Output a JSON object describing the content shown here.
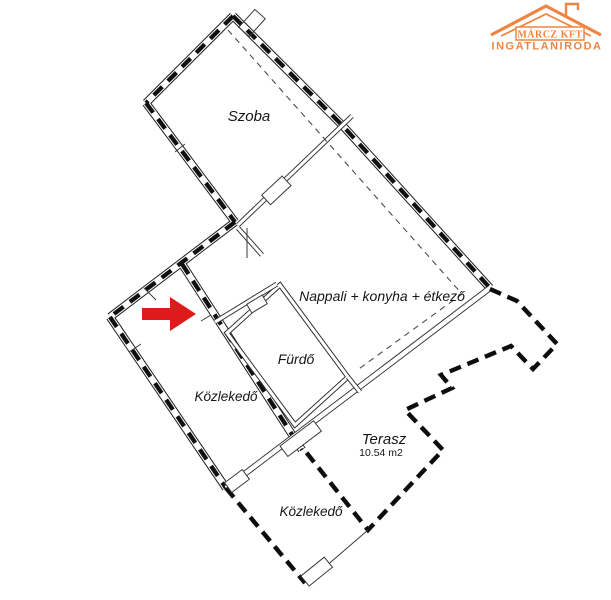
{
  "logo": {
    "company": "MÁRCZ KFT",
    "subtitle": "INGATLANIRODA",
    "accent_color": "#ED8540"
  },
  "rooms": {
    "szoba": {
      "label": "Szoba"
    },
    "nappali": {
      "label": "Nappali + konyha + étkező"
    },
    "furdo": {
      "label": "Fürdő"
    },
    "kozlekedo_left": {
      "label": "Közlekedő"
    },
    "terasz": {
      "label": "Terasz",
      "area": "10.54 m2"
    },
    "kozlekedo_bottom": {
      "label": "Közlekedő"
    }
  },
  "marker": {
    "color": "#DE1B1B",
    "shape": "arrow-right"
  }
}
